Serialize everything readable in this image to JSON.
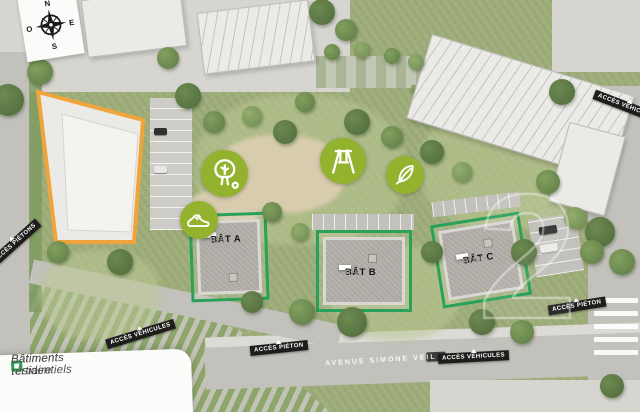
{
  "compass": {
    "n": "N",
    "e": "E",
    "s": "S",
    "o": "O"
  },
  "buildings": {
    "a": {
      "name": "BÂT A",
      "floors": "R+5"
    },
    "b": {
      "name": "BÂT B",
      "floors": "R+9"
    },
    "c": {
      "name": "BÂT C",
      "floors": "R+10"
    }
  },
  "streets": {
    "avenue_label": "AVENUE SIMONE VEIL"
  },
  "access": {
    "left_pedestrian": "ACCÈS PIÉTONS",
    "allee_vehicles": "ACCÈS VÉHICULES",
    "bottom_pedestrian": "ACCÈS PIÉTON",
    "avenue_vehicles": "ACCÈS VÉHICULES",
    "right_pedestrian": "ACCÈS PIÉTON",
    "top_right_vehicles": "ACCÈS VÉHICULES"
  },
  "legend": {
    "items": [
      {
        "label": "Bâtiment tertiaire",
        "color": "#f0a53c"
      },
      {
        "label": "Bâtiments résidentiels",
        "color": "#2aa158"
      }
    ]
  },
  "amenities": [
    "running-shoe",
    "tree",
    "swing",
    "leaf"
  ],
  "watermark": {
    "text": "2"
  },
  "colors": {
    "tertiary_accent": "#f0a53c",
    "residential_accent": "#2aa158",
    "amenity_circle": "#93b22e"
  }
}
